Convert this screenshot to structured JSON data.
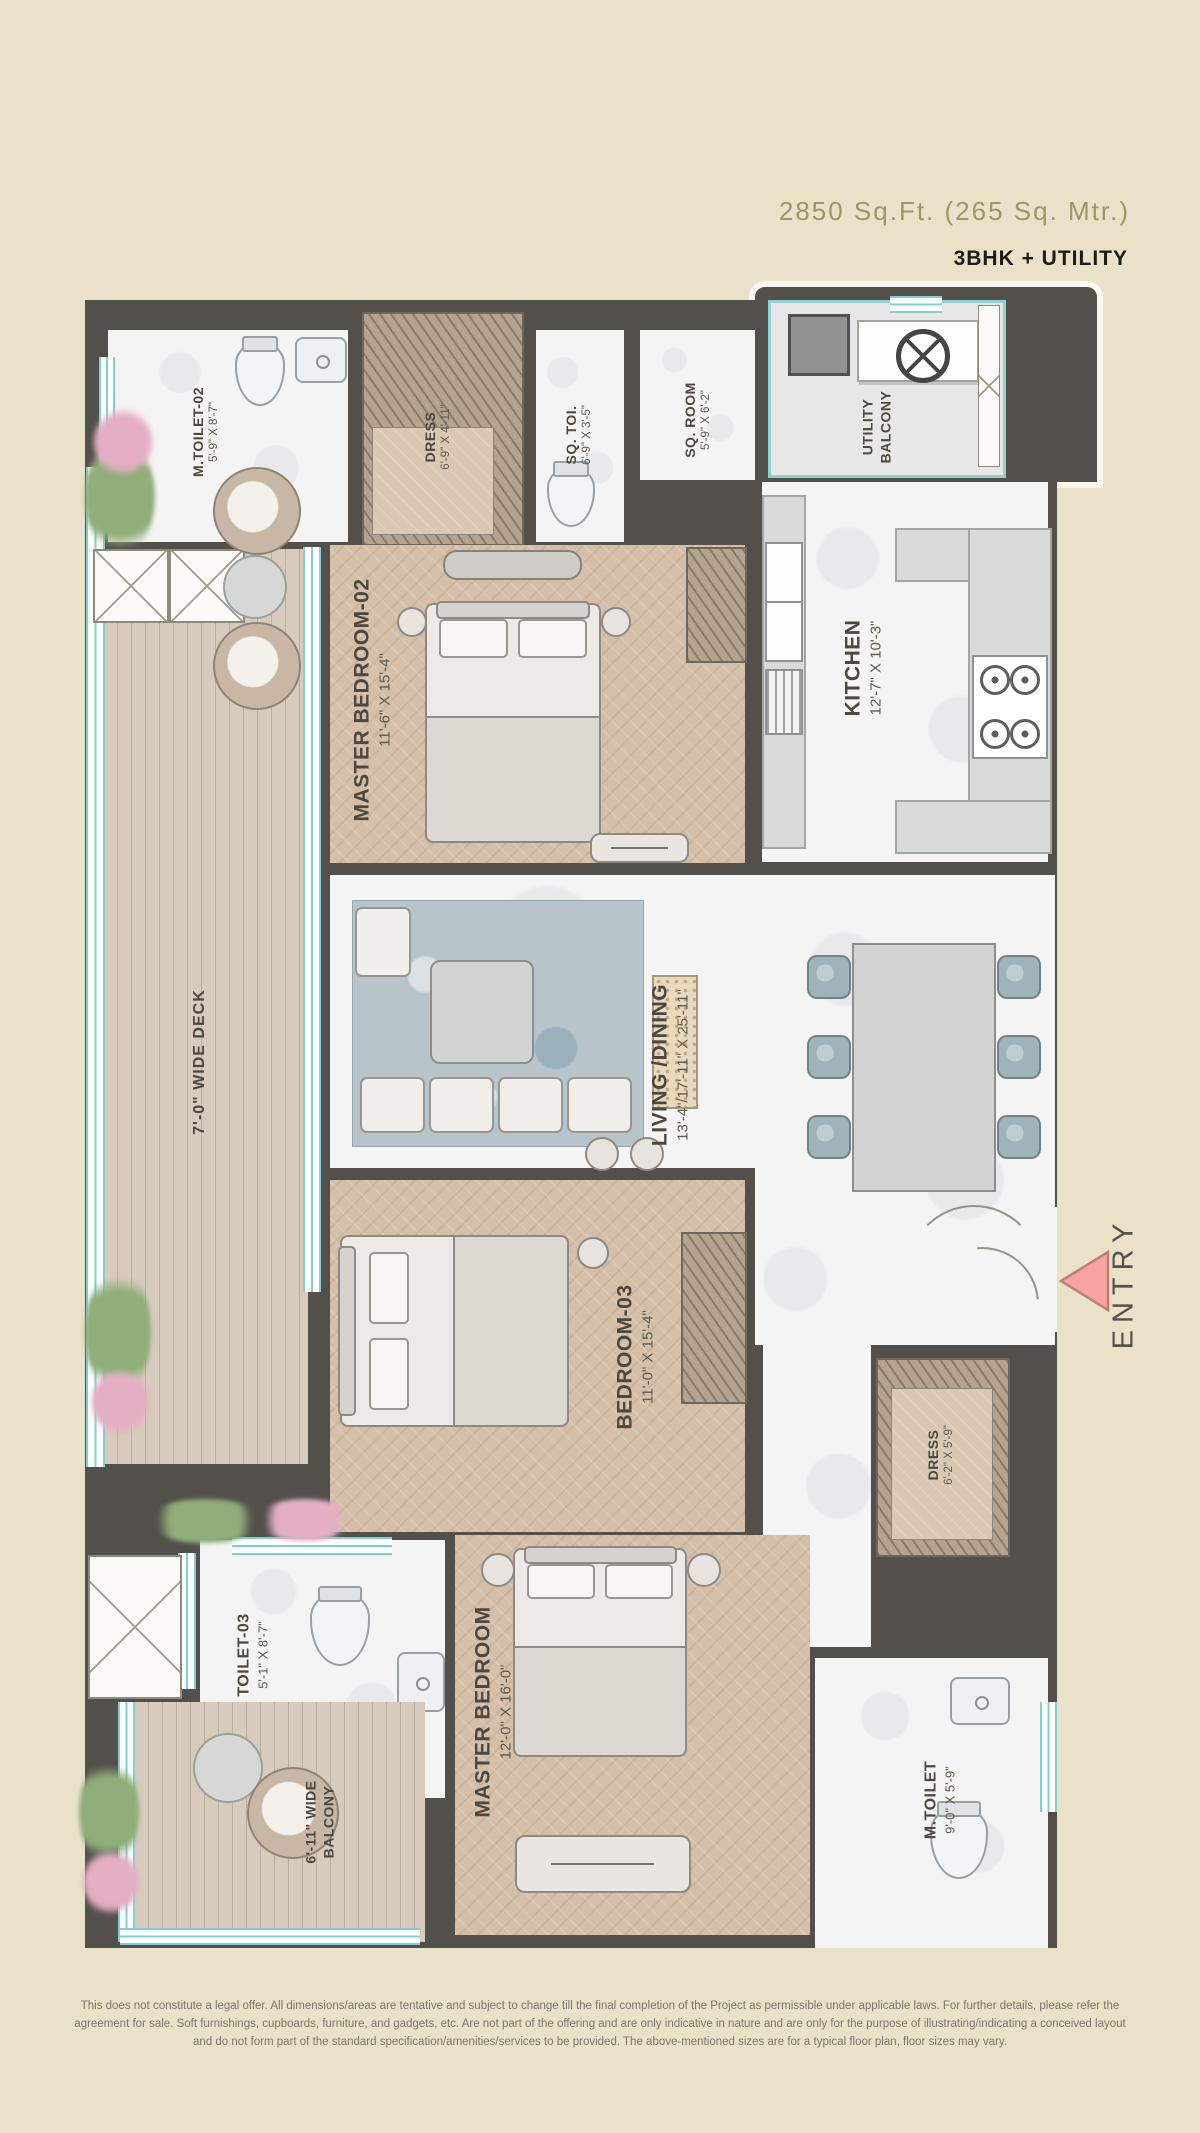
{
  "header": {
    "area": "2850 Sq.Ft.  (265 Sq. Mtr.)",
    "config": "3BHK + UTILITY"
  },
  "rooms": {
    "m_toilet_02": {
      "name": "M.TOILET-02",
      "dim": "5'-9\" X 8'-7\""
    },
    "dress_1": {
      "name": "DRESS",
      "dim": "6'-9\" X 4'-11\""
    },
    "sq_toi": {
      "name": "SQ. TOI.",
      "dim": "6'-9\" X 3'-5\""
    },
    "sq_room": {
      "name": "SQ. ROOM",
      "dim": "5'-9\" X 6'-2\""
    },
    "utility_balcony": {
      "name": "UTILITY BALCONY",
      "dim": ""
    },
    "kitchen": {
      "name": "KITCHEN",
      "dim": "12'-7\" X 10'-3\""
    },
    "master_bedroom_02": {
      "name": "MASTER BEDROOM-02",
      "dim": "11'-6\" X 15'-4\""
    },
    "living_dining": {
      "name": "LIVING /DINING",
      "dim": "13'-4\"/17'-11\" X 25'-11\""
    },
    "deck": {
      "name": "7'-0\" WIDE DECK",
      "dim": ""
    },
    "bedroom_03": {
      "name": "BEDROOM-03",
      "dim": "11'-0\" X 15'-4\""
    },
    "dress_2": {
      "name": "DRESS",
      "dim": "6'-2\" X 5'-9\""
    },
    "toilet_03": {
      "name": "TOILET-03",
      "dim": "5'-1\" X 8'-7\""
    },
    "master_bedroom": {
      "name": "MASTER BEDROOM",
      "dim": "12'-0\" X 16'-0\""
    },
    "m_toilet": {
      "name": "M.TOILET",
      "dim": "9'-0\" X 5'-9\""
    },
    "balcony": {
      "name": "6'-11\" WIDE BALCONY",
      "dim": ""
    }
  },
  "entry": {
    "label": "ENTRY"
  },
  "colors": {
    "background": "#eae1c9",
    "wall": "#53504c",
    "window_accent": "#7ecfd6",
    "entry_arrow": "#f7a3a2",
    "wood_floor": "#d5bfa8",
    "marble_floor": "#f4f4f5",
    "deck_wood": "#d8cbbd",
    "label_text": "#4c473f",
    "title_text": "#a09568"
  },
  "disclaimer": "This does not constitute a legal offer. All dimensions/areas are tentative and subject to change till the final completion of the Project as permissible under applicable laws. For further details, please refer the agreement for sale. Soft furnishings, cupboards, furniture, and gadgets, etc. Are not part of the offering and are only indicative in nature and are only for the purpose of illustrating/indicating a conceived layout and do not form part of the standard specification/amenities/services to be provided. The above-mentioned sizes are for a typical floor plan, floor sizes may vary."
}
